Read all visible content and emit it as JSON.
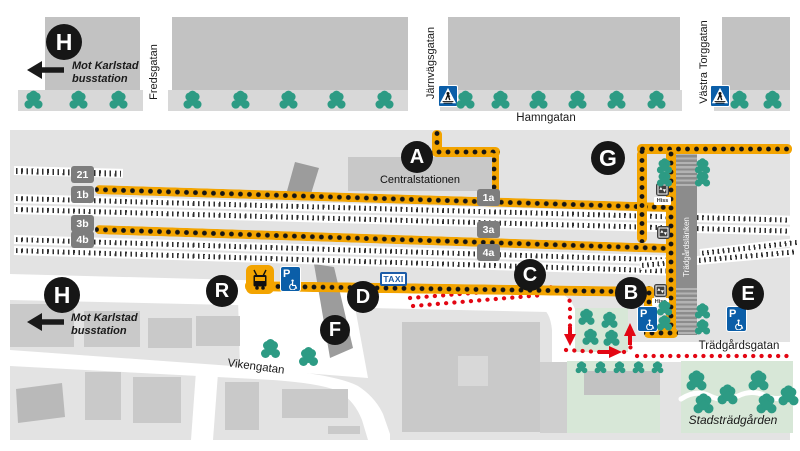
{
  "map": {
    "street_labels": {
      "hamngatan": "Hamngatan",
      "fredsgatan": "Fredsgatan",
      "jarnvagsgatan": "Järnvägsgatan",
      "vastra_torggatan": "Västra Torggatan",
      "vikengatan": "Vikengatan",
      "tradgardsgatan": "Trädgårdsgatan",
      "tradgardslanken": "Trädgårdslänken"
    },
    "place_labels": {
      "centralstationen": "Centralstationen",
      "stadstradgarden": "Stadsträdgården"
    },
    "direction_note": {
      "line1": "Mot Karlstad",
      "line2": "busstation"
    },
    "signs": {
      "taxi": "TAXI",
      "parking": "P",
      "elevator": "Hiss"
    },
    "stop_markers": [
      {
        "letter": "H",
        "x": 64,
        "y": 42,
        "r": 18
      },
      {
        "letter": "A",
        "x": 417,
        "y": 157,
        "r": 16
      },
      {
        "letter": "G",
        "x": 608,
        "y": 158,
        "r": 17
      },
      {
        "letter": "C",
        "x": 530,
        "y": 275,
        "r": 16
      },
      {
        "letter": "B",
        "x": 631,
        "y": 293,
        "r": 16
      },
      {
        "letter": "D",
        "x": 363,
        "y": 297,
        "r": 16
      },
      {
        "letter": "E",
        "x": 748,
        "y": 294,
        "r": 16
      },
      {
        "letter": "F",
        "x": 335,
        "y": 330,
        "r": 15
      },
      {
        "letter": "R",
        "x": 222,
        "y": 291,
        "r": 16
      },
      {
        "letter": "H",
        "x": 62,
        "y": 295,
        "r": 18
      }
    ],
    "platform_signs": [
      {
        "label": "21",
        "x": 71,
        "y": 166
      },
      {
        "label": "1b",
        "x": 71,
        "y": 186
      },
      {
        "label": "3b",
        "x": 71,
        "y": 215
      },
      {
        "label": "4b",
        "x": 71,
        "y": 231
      },
      {
        "label": "1a",
        "x": 477,
        "y": 189
      },
      {
        "label": "3a",
        "x": 477,
        "y": 221
      },
      {
        "label": "4a",
        "x": 477,
        "y": 244
      }
    ],
    "parking_signs": [
      {
        "x": 280,
        "y": 266
      },
      {
        "x": 637,
        "y": 306
      },
      {
        "x": 726,
        "y": 306
      }
    ],
    "crosswalk_signs": [
      {
        "x": 438,
        "y": 85
      },
      {
        "x": 710,
        "y": 85
      }
    ],
    "elevator_signs": [
      {
        "x": 656,
        "y": 183,
        "show_label": true
      },
      {
        "x": 657,
        "y": 226,
        "show_label": false
      },
      {
        "x": 654,
        "y": 284,
        "show_label": true
      }
    ],
    "colors": {
      "walking_route": "#f3a400",
      "car_route": "#e30613",
      "tree": "#2d9b84",
      "sign_blue": "#0b5ea8",
      "marker": "#161616",
      "park_green": "#d7e7d7"
    },
    "tree_groups": [
      {
        "scale": 0.95,
        "points": [
          [
            33,
            100
          ],
          [
            78,
            100
          ],
          [
            118,
            100
          ],
          [
            192,
            100
          ],
          [
            240,
            100
          ],
          [
            288,
            100
          ],
          [
            336,
            100
          ],
          [
            384,
            100
          ],
          [
            465,
            100
          ],
          [
            500,
            100
          ],
          [
            538,
            100
          ],
          [
            577,
            100
          ],
          [
            616,
            100
          ],
          [
            656,
            100
          ],
          [
            739,
            100
          ],
          [
            772,
            100
          ]
        ]
      },
      {
        "scale": 0.8,
        "points": [
          [
            664,
            166
          ],
          [
            664,
            179
          ],
          [
            702,
            166
          ],
          [
            702,
            179
          ],
          [
            664,
            308
          ],
          [
            664,
            323
          ],
          [
            702,
            311
          ],
          [
            702,
            327
          ]
        ]
      },
      {
        "scale": 1,
        "points": [
          [
            270,
            349
          ],
          [
            308,
            357
          ]
        ]
      },
      {
        "scale": 0.85,
        "points": [
          [
            586,
            317
          ],
          [
            609,
            320
          ],
          [
            590,
            337
          ],
          [
            611,
            338
          ]
        ]
      },
      {
        "scale": 0.62,
        "points": [
          [
            581,
            367
          ],
          [
            600,
            367
          ],
          [
            619,
            367
          ],
          [
            638,
            367
          ],
          [
            657,
            367
          ]
        ]
      },
      {
        "scale": 1.05,
        "points": [
          [
            696,
            381
          ],
          [
            727,
            395
          ],
          [
            758,
            381
          ],
          [
            788,
            396
          ],
          [
            703,
            404
          ],
          [
            766,
            404
          ]
        ]
      }
    ]
  }
}
